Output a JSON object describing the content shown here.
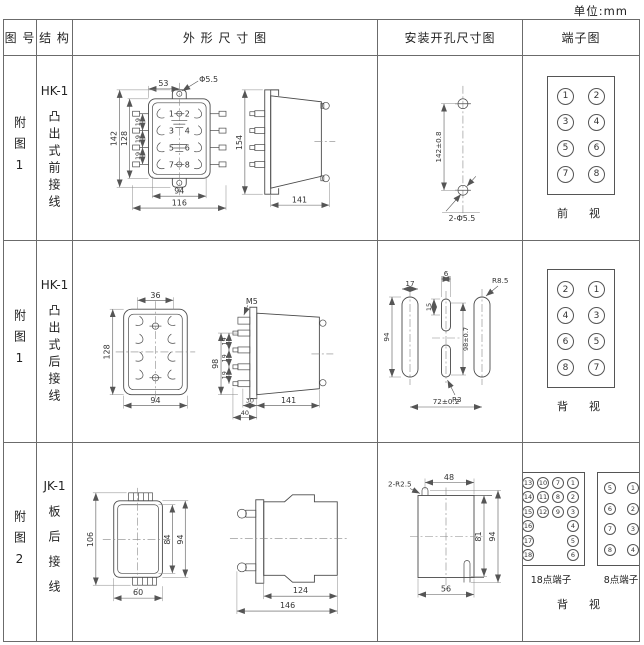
{
  "unit_label": "单位:mm",
  "header": {
    "figure": "图 号",
    "structure": "结 构",
    "outline": "外 形 尺 寸 图",
    "mounting": "安装开孔尺寸图",
    "terminal": "端子图"
  },
  "rows": [
    {
      "figure": "附图1",
      "model": "HK-1",
      "structure": "凸出式前接线",
      "outline": {
        "top_width": "53",
        "hole_dia": "Φ5.5",
        "overall_h": "142",
        "body_h": "128",
        "pitch1": "19",
        "pitch2": "19",
        "pitch3": "19",
        "inner_w": "94",
        "overall_w": "116",
        "side_h": "154",
        "side_d": "141",
        "pins": [
          "1",
          "2",
          "3",
          "4",
          "5",
          "6",
          "7",
          "8"
        ]
      },
      "mounting": {
        "v_dist": "142±0.8",
        "holes": "2-Φ5.5"
      },
      "terminal": {
        "pins_left": [
          "1",
          "3",
          "5",
          "7"
        ],
        "pins_right": [
          "2",
          "4",
          "6",
          "8"
        ],
        "caption": "前　视"
      }
    },
    {
      "figure": "附图1",
      "model": "HK-1",
      "structure": "凸出式后接线",
      "outline": {
        "top_width": "36",
        "body_h": "128",
        "body_w": "94",
        "stud": "M5",
        "group_h": "98",
        "pitch1": "19",
        "pitch2": "19",
        "pitch3": "19",
        "d1": "30",
        "d2": "40",
        "side_d": "141"
      },
      "mounting": {
        "slot_w": "17",
        "small_w": "6",
        "small_h": "15",
        "slot_h": "94",
        "v_dist": "98±0.7",
        "r_big": "R8.5",
        "r_small": "R3",
        "h_dist": "72±0.2"
      },
      "terminal": {
        "pins_left": [
          "2",
          "4",
          "6",
          "8"
        ],
        "pins_right": [
          "1",
          "3",
          "5",
          "7"
        ],
        "caption": "背　视"
      }
    },
    {
      "figure": "附图2",
      "model": "JK-1",
      "structure": "板后接线",
      "outline": {
        "overall_h": "106",
        "inner_h": "84",
        "body_h": "94",
        "body_w": "60",
        "side_d1": "124",
        "side_d2": "146"
      },
      "mounting": {
        "notch": "2-R2.5",
        "top_w": "48",
        "inner_h": "81",
        "overall_h": "94",
        "bottom_w": "56"
      },
      "terminal": {
        "t18_label": "18点端子",
        "t8_label": "8点端子",
        "caption": "背　视",
        "t18": [
          "13",
          "10",
          "7",
          "1",
          "14",
          "11",
          "8",
          "2",
          "15",
          "12",
          "9",
          "3",
          "16",
          "",
          "",
          "4",
          "17",
          "",
          "",
          "5",
          "18",
          "",
          "",
          "6"
        ],
        "t8_left": [
          "5",
          "6",
          "7",
          "8"
        ],
        "t8_right": [
          "1",
          "2",
          "3",
          "4"
        ]
      }
    }
  ]
}
